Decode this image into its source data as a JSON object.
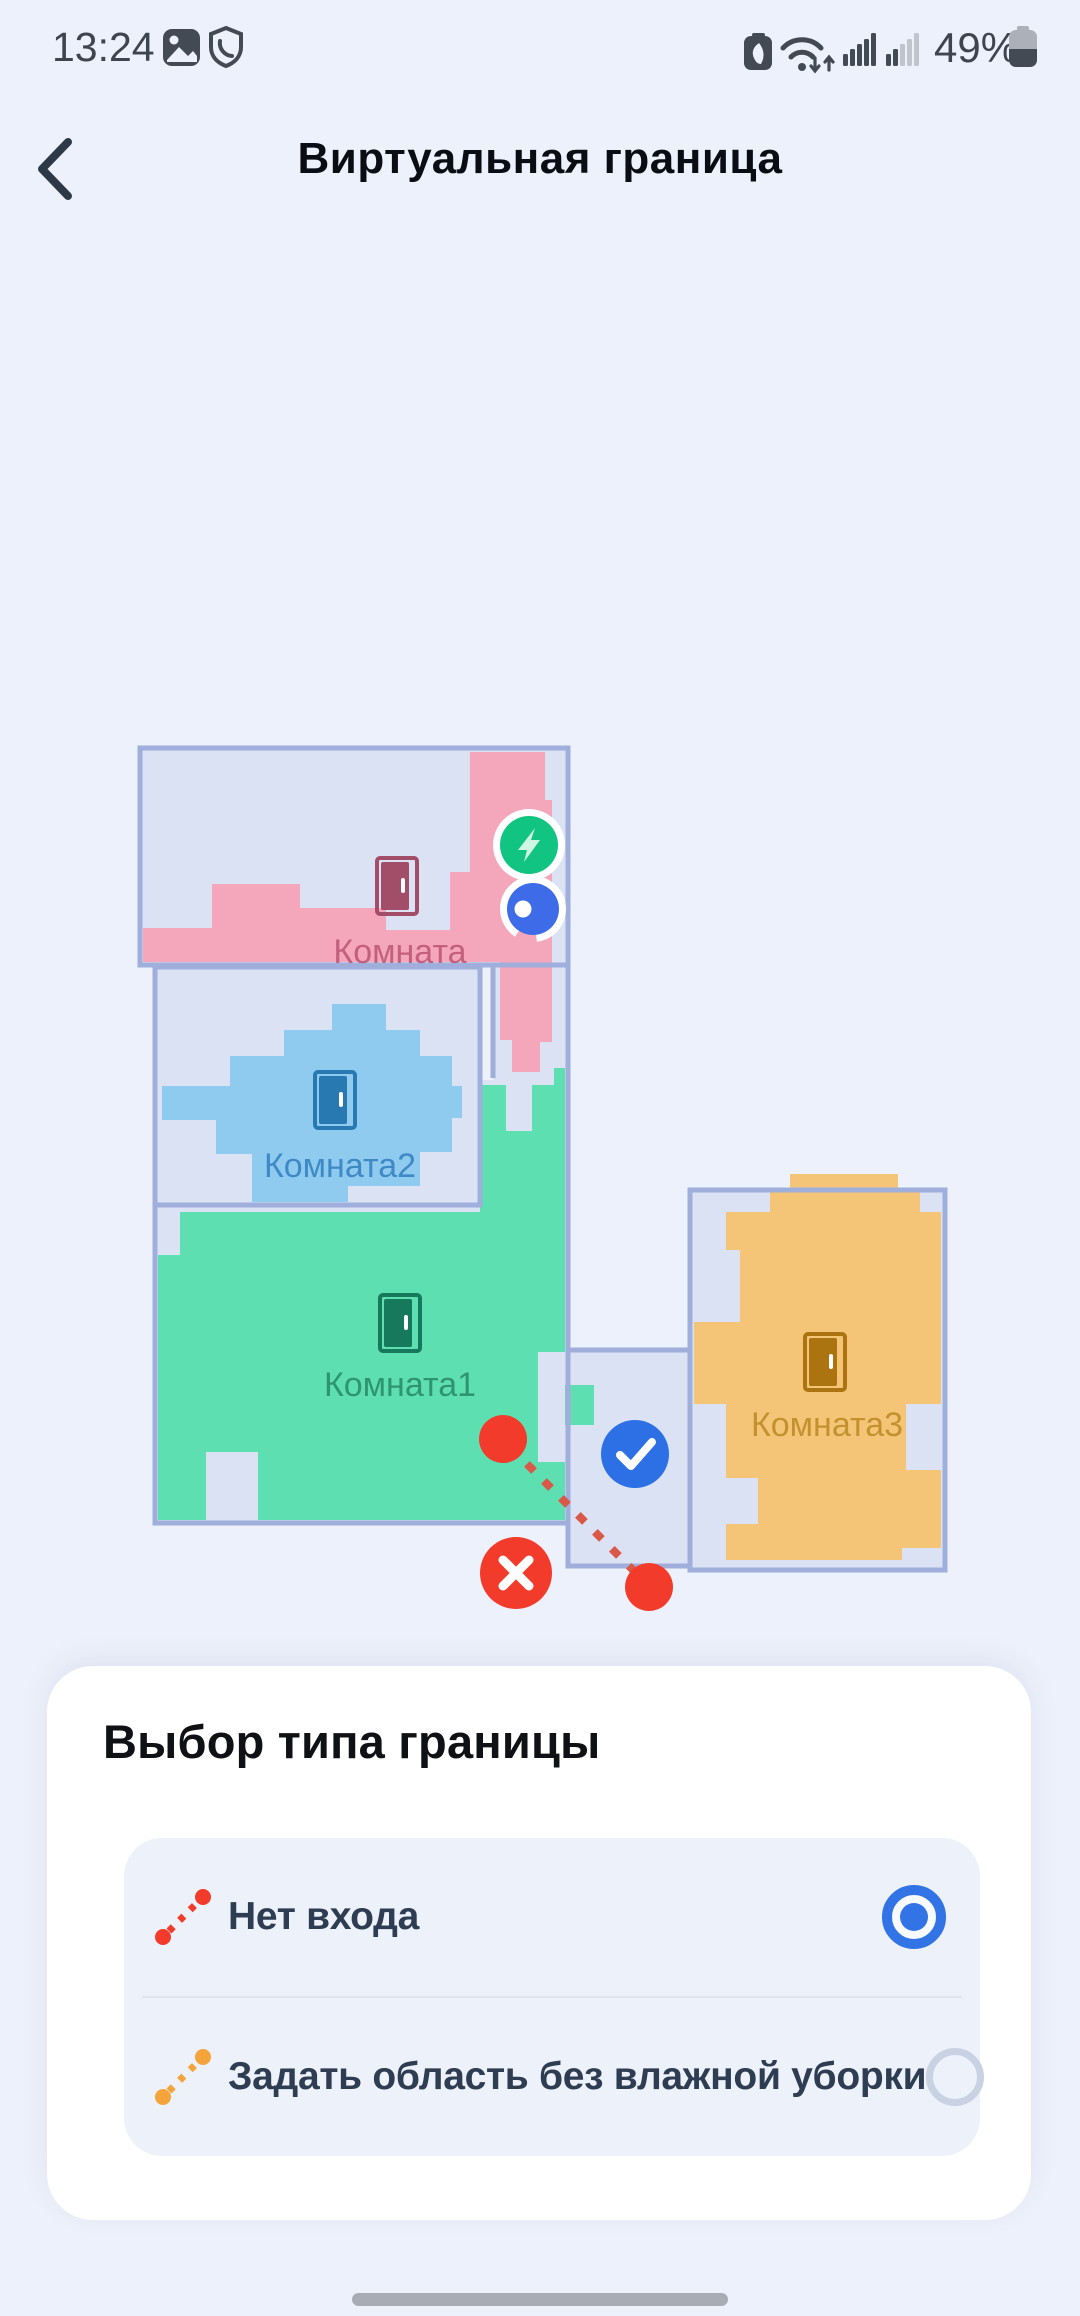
{
  "status_bar": {
    "time": "13:24",
    "battery_percent": "49%",
    "icons_left": [
      "gallery-icon",
      "shield-phone-icon"
    ],
    "icons_right": [
      "battery-saver-icon",
      "wifi-icon",
      "signal-bars-icon",
      "signal-bars-weak-icon",
      "battery-icon"
    ]
  },
  "header": {
    "title": "Виртуальная граница"
  },
  "map": {
    "rooms": [
      {
        "id": "room-pink",
        "label": "Комната"
      },
      {
        "id": "room-blue",
        "label": "Комната2"
      },
      {
        "id": "room-green",
        "label": "Комната1"
      },
      {
        "id": "room-orange",
        "label": "Комната3"
      }
    ],
    "markers": [
      "charging-dock",
      "robot-vacuum",
      "boundary-line",
      "confirm-button",
      "delete-button"
    ],
    "colors": {
      "background": "#EDF1FB",
      "room_base": "#DBE2F4",
      "room_border": "#9FAEDB",
      "pink": "#F4A6BB",
      "blue": "#8FCAEF",
      "green": "#5EDFB1",
      "orange": "#F4C577",
      "door_pink": "#A34E68",
      "door_blue": "#2878B2",
      "door_green": "#17795B",
      "door_orange": "#AC7410",
      "label_pink": "#C2607D",
      "label_blue": "#4089C7",
      "label_green": "#2E9471",
      "label_orange": "#C3922F",
      "robot": "#3E6CE8",
      "dock": "#12C481",
      "dock_bolt": "#CDF6E3",
      "accent_blue": "#2D6FE4",
      "danger": "#F23B2A",
      "dash_red": "#D95848"
    }
  },
  "sheet": {
    "title": "Выбор типа границы",
    "options": [
      {
        "label": "Нет входа",
        "selected": true,
        "line_color": "#F23B2A"
      },
      {
        "label": "Задать область без влажной уборки",
        "selected": false,
        "line_color": "#F5A43C"
      }
    ]
  }
}
